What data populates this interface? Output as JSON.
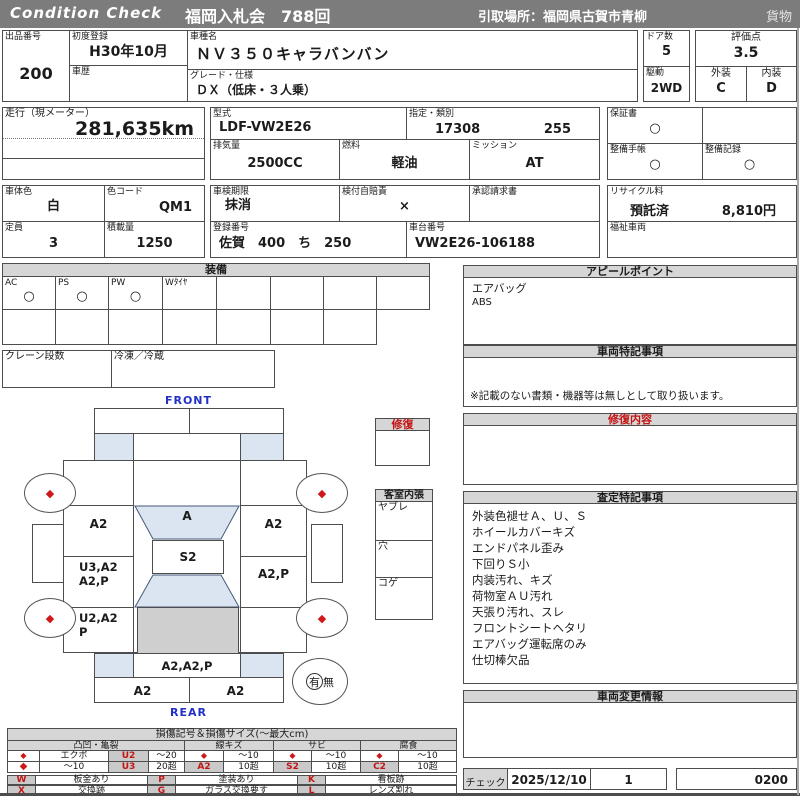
{
  "header": {
    "brand": "Condition  Check",
    "auction": "福岡入札会　788回",
    "pickup": "引取場所：福岡県古賀市青柳",
    "category": "貨物"
  },
  "vehicle": {
    "lot_label": "出品番号",
    "lot": "200",
    "first_reg_label": "初度登録",
    "first_reg": "H30年10月",
    "history_label": "車歴",
    "model_label": "車種名",
    "model": "ＮＶ３５０キャラバンバン",
    "grade_label": "グレード・仕様",
    "grade": "ＤＸ（低床・３人乗）",
    "doors_label": "ドア数",
    "doors": "5",
    "drive_label": "駆動",
    "drive": "2WD",
    "rating_label": "評価点",
    "rating": "3.5",
    "exterior_label": "外装",
    "exterior": "C",
    "interior_label": "内装",
    "interior": "D"
  },
  "meter": {
    "label": "走行（現メーター）",
    "value": "281,635km"
  },
  "spec": {
    "model_code_label": "型式",
    "model_code": "LDF-VW2E26",
    "class_label": "指定・類別",
    "class_a": "17308",
    "class_b": "255",
    "disp_label": "排気量",
    "disp": "2500CC",
    "fuel_label": "燃料",
    "fuel": "軽油",
    "mission_label": "ミッション",
    "mission": "AT"
  },
  "docs": {
    "warranty_label": "保証書",
    "warranty": "○",
    "manual_label": "整備手帳",
    "manual": "○",
    "record_label": "整備記録",
    "record": "○"
  },
  "reg": {
    "body_color_label": "車体色",
    "body_color": "白",
    "color_code_label": "色コード",
    "color_code": "QM1",
    "capacity_label": "定員",
    "capacity": "3",
    "load_label": "積載量",
    "load": "1250",
    "inspect_label": "車検期限",
    "inspect": "抹消",
    "jibaiseki_label": "検付自賠責",
    "jibaiseki": "×",
    "approval_label": "承認請求書",
    "regno_label": "登録番号",
    "regno": "佐賀　400　ち　250",
    "chassis_label": "車台番号",
    "chassis": "VW2E26-106188",
    "recycle_label": "リサイクル料",
    "recycle_status": "預託済",
    "recycle_fee": "8,810円",
    "welfare_label": "福祉車両"
  },
  "equipment": {
    "title": "装備",
    "items": [
      {
        "label": "AC",
        "mark": "○"
      },
      {
        "label": "PS",
        "mark": "○"
      },
      {
        "label": "PW",
        "mark": "○"
      },
      {
        "label": "Wﾀｲﾔ",
        "mark": ""
      },
      {
        "label": "",
        "mark": ""
      },
      {
        "label": "",
        "mark": ""
      },
      {
        "label": "",
        "mark": ""
      },
      {
        "label": "",
        "mark": ""
      }
    ],
    "crane_label": "クレーン段数",
    "fridge_label": "冷凍／冷蔵"
  },
  "appeal": {
    "title": "アピールポイント",
    "lines": [
      "エアバッグ",
      "ABS"
    ]
  },
  "special": {
    "title": "車両特記事項",
    "note": "※記載のない書類・機器等は無しとして取り扱います。"
  },
  "repair": {
    "box_title": "修復",
    "content_title": "修復内容"
  },
  "cabin": {
    "title": "客室内張",
    "rows": [
      "ヤブレ",
      "穴",
      "コゲ"
    ]
  },
  "assessment": {
    "title": "査定特記事項",
    "lines": [
      "外装色褪せＡ、Ｕ、Ｓ",
      "ホイールカバーキズ",
      "エンドパネル歪み",
      "下回りＳ小",
      "内装汚れ、キズ",
      "荷物室ＡＵ汚れ",
      "天張り汚れ、スレ",
      "フロントシートヘタリ",
      "エアバッグ運転席のみ",
      "仕切棒欠品"
    ]
  },
  "change": {
    "title": "車両変更情報"
  },
  "check": {
    "label": "チェック",
    "date": "2025/12/10",
    "number": "1",
    "code": "0200"
  },
  "diagram": {
    "front": "FRONT",
    "rear": "REAR",
    "labels": {
      "left_top": "A2",
      "left_mid_1": "U3,A2",
      "left_mid_2": "A2,P",
      "left_low_1": "U2,A2",
      "left_low_2": "P",
      "right_top": "A2",
      "right_mid": "A2,P",
      "windshield": "A",
      "roof": "S2",
      "tailgate": "A2,A2,P",
      "bumper_l": "A2",
      "bumper_r": "A2"
    },
    "presence": {
      "yes": "有",
      "no": "無"
    }
  },
  "legend": {
    "title": "損傷記号＆損傷サイズ(〜最大cm)",
    "dent": {
      "header": "凸凹・亀裂",
      "r1": [
        "◆",
        "エクボ",
        "U2",
        "〜20"
      ],
      "r2": [
        "◆",
        "〜10",
        "U3",
        "20超"
      ]
    },
    "scratch": {
      "header": "線キズ",
      "r1": [
        "◆",
        "〜10"
      ],
      "r2": [
        "A2",
        "10超"
      ]
    },
    "rust": {
      "header": "サビ",
      "r1": [
        "◆",
        "〜10"
      ],
      "r2": [
        "S2",
        "10超"
      ]
    },
    "corrosion": {
      "header": "腐食",
      "r1": [
        "◆",
        "〜10"
      ],
      "r2": [
        "C2",
        "10超"
      ]
    },
    "marks_r1": [
      {
        "k": "W",
        "v": "板金あり"
      },
      {
        "k": "P",
        "v": "塗装あり"
      },
      {
        "k": "K",
        "v": "看板跡"
      }
    ],
    "marks_r2": [
      {
        "k": "X",
        "v": "交換跡"
      },
      {
        "k": "G",
        "v": "ガラス交換要す"
      },
      {
        "k": "L",
        "v": "レンズ割れ"
      }
    ]
  },
  "icons": {
    "diamond": "◆"
  },
  "colors": {
    "accent_red": "#c41414",
    "label_blue": "#2230c8",
    "panel_blue": "#dbe5f1",
    "panel_gray": "#cfcfcf",
    "bar_gray": "#7c7c7c",
    "header_gray": "#d6d6d6"
  }
}
